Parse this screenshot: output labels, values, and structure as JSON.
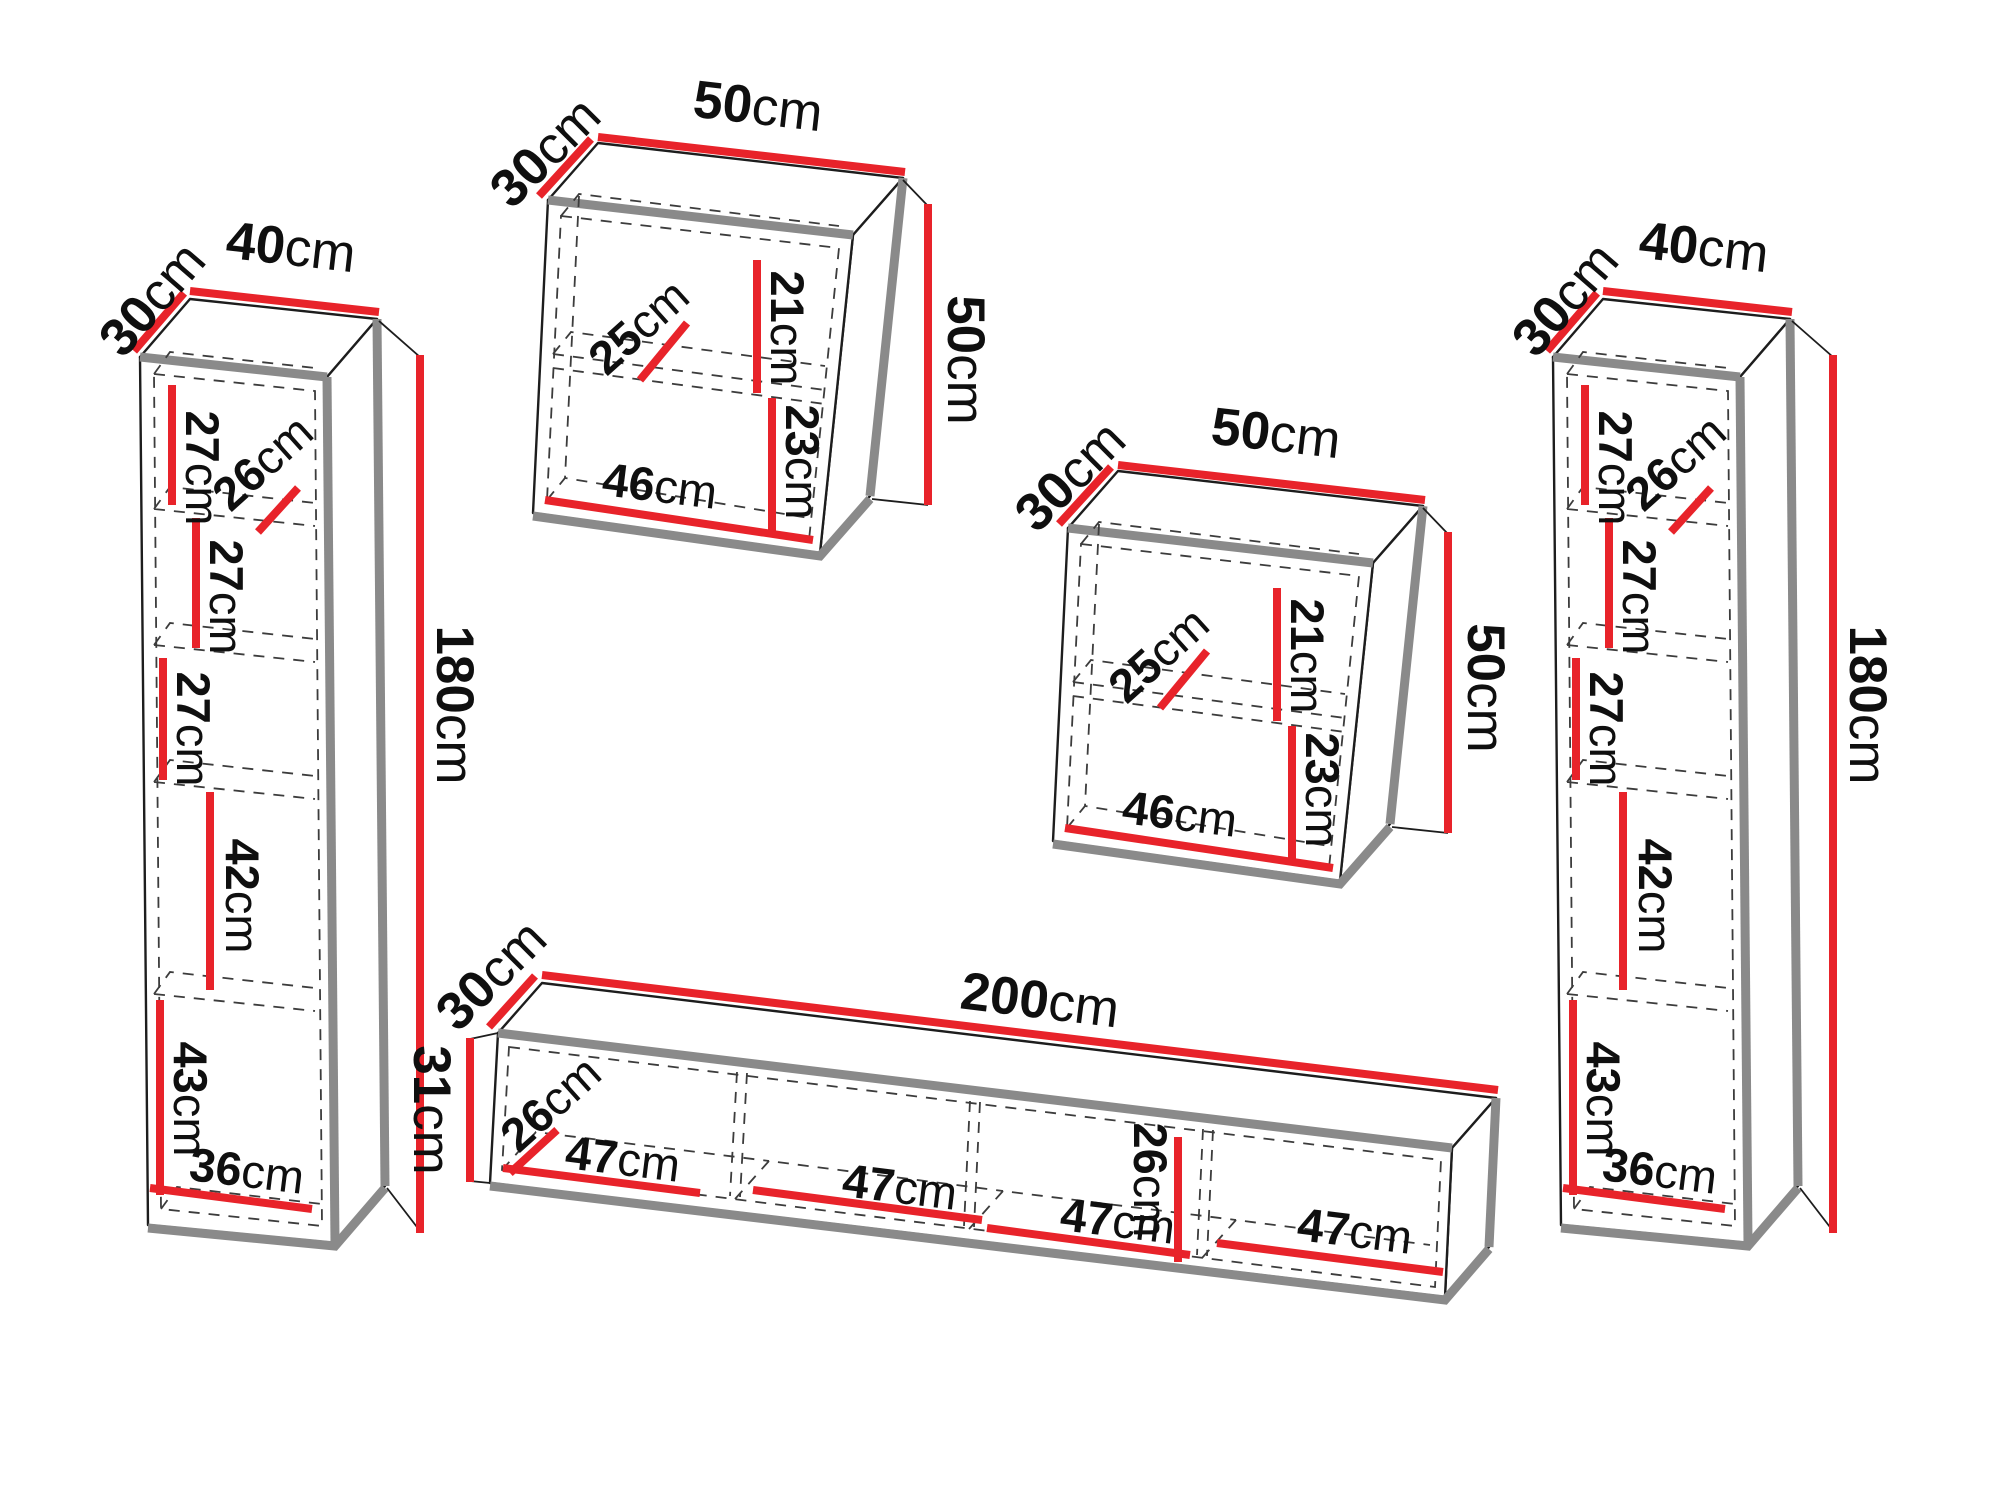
{
  "colors": {
    "dimension_red": "#e8232a",
    "outline": "#1d1d1d",
    "shadow_gray": "#8a8a8a",
    "dashed_line": "#3c3c3c",
    "label_text": "#0f0f0f",
    "background": "#ffffff"
  },
  "pieces": {
    "left_column": {
      "depth": {
        "n": "30",
        "u": "cm"
      },
      "width": {
        "n": "40",
        "u": "cm"
      },
      "height": {
        "n": "180",
        "u": "cm"
      },
      "compartment1": {
        "n": "27",
        "u": "cm"
      },
      "shelf_depth": {
        "n": "26",
        "u": "cm"
      },
      "compartment2": {
        "n": "27",
        "u": "cm"
      },
      "compartment3": {
        "n": "27",
        "u": "cm"
      },
      "compartment4": {
        "n": "42",
        "u": "cm"
      },
      "compartment5": {
        "n": "43",
        "u": "cm"
      },
      "inner_width": {
        "n": "36",
        "u": "cm"
      }
    },
    "top_cabinet": {
      "depth": {
        "n": "30",
        "u": "cm"
      },
      "width": {
        "n": "50",
        "u": "cm"
      },
      "height": {
        "n": "50",
        "u": "cm"
      },
      "shelf_depth": {
        "n": "25",
        "u": "cm"
      },
      "upper_compartment": {
        "n": "21",
        "u": "cm"
      },
      "lower_compartment": {
        "n": "23",
        "u": "cm"
      },
      "inner_width": {
        "n": "46",
        "u": "cm"
      }
    },
    "mid_cabinet": {
      "depth": {
        "n": "30",
        "u": "cm"
      },
      "width": {
        "n": "50",
        "u": "cm"
      },
      "height": {
        "n": "50",
        "u": "cm"
      },
      "shelf_depth": {
        "n": "25",
        "u": "cm"
      },
      "upper_compartment": {
        "n": "21",
        "u": "cm"
      },
      "lower_compartment": {
        "n": "23",
        "u": "cm"
      },
      "inner_width": {
        "n": "46",
        "u": "cm"
      }
    },
    "tv_stand": {
      "depth": {
        "n": "30",
        "u": "cm"
      },
      "width": {
        "n": "200",
        "u": "cm"
      },
      "height": {
        "n": "31",
        "u": "cm"
      },
      "inner_depth": {
        "n": "26",
        "u": "cm"
      },
      "inner_height": {
        "n": "26",
        "u": "cm"
      },
      "bay1": {
        "n": "47",
        "u": "cm"
      },
      "bay2": {
        "n": "47",
        "u": "cm"
      },
      "bay3": {
        "n": "47",
        "u": "cm"
      },
      "bay4": {
        "n": "47",
        "u": "cm"
      }
    },
    "right_column": {
      "depth": {
        "n": "30",
        "u": "cm"
      },
      "width": {
        "n": "40",
        "u": "cm"
      },
      "height": {
        "n": "180",
        "u": "cm"
      },
      "compartment1": {
        "n": "27",
        "u": "cm"
      },
      "shelf_depth": {
        "n": "26",
        "u": "cm"
      },
      "compartment2": {
        "n": "27",
        "u": "cm"
      },
      "compartment3": {
        "n": "27",
        "u": "cm"
      },
      "compartment4": {
        "n": "42",
        "u": "cm"
      },
      "compartment5": {
        "n": "43",
        "u": "cm"
      },
      "inner_width": {
        "n": "36",
        "u": "cm"
      }
    }
  }
}
